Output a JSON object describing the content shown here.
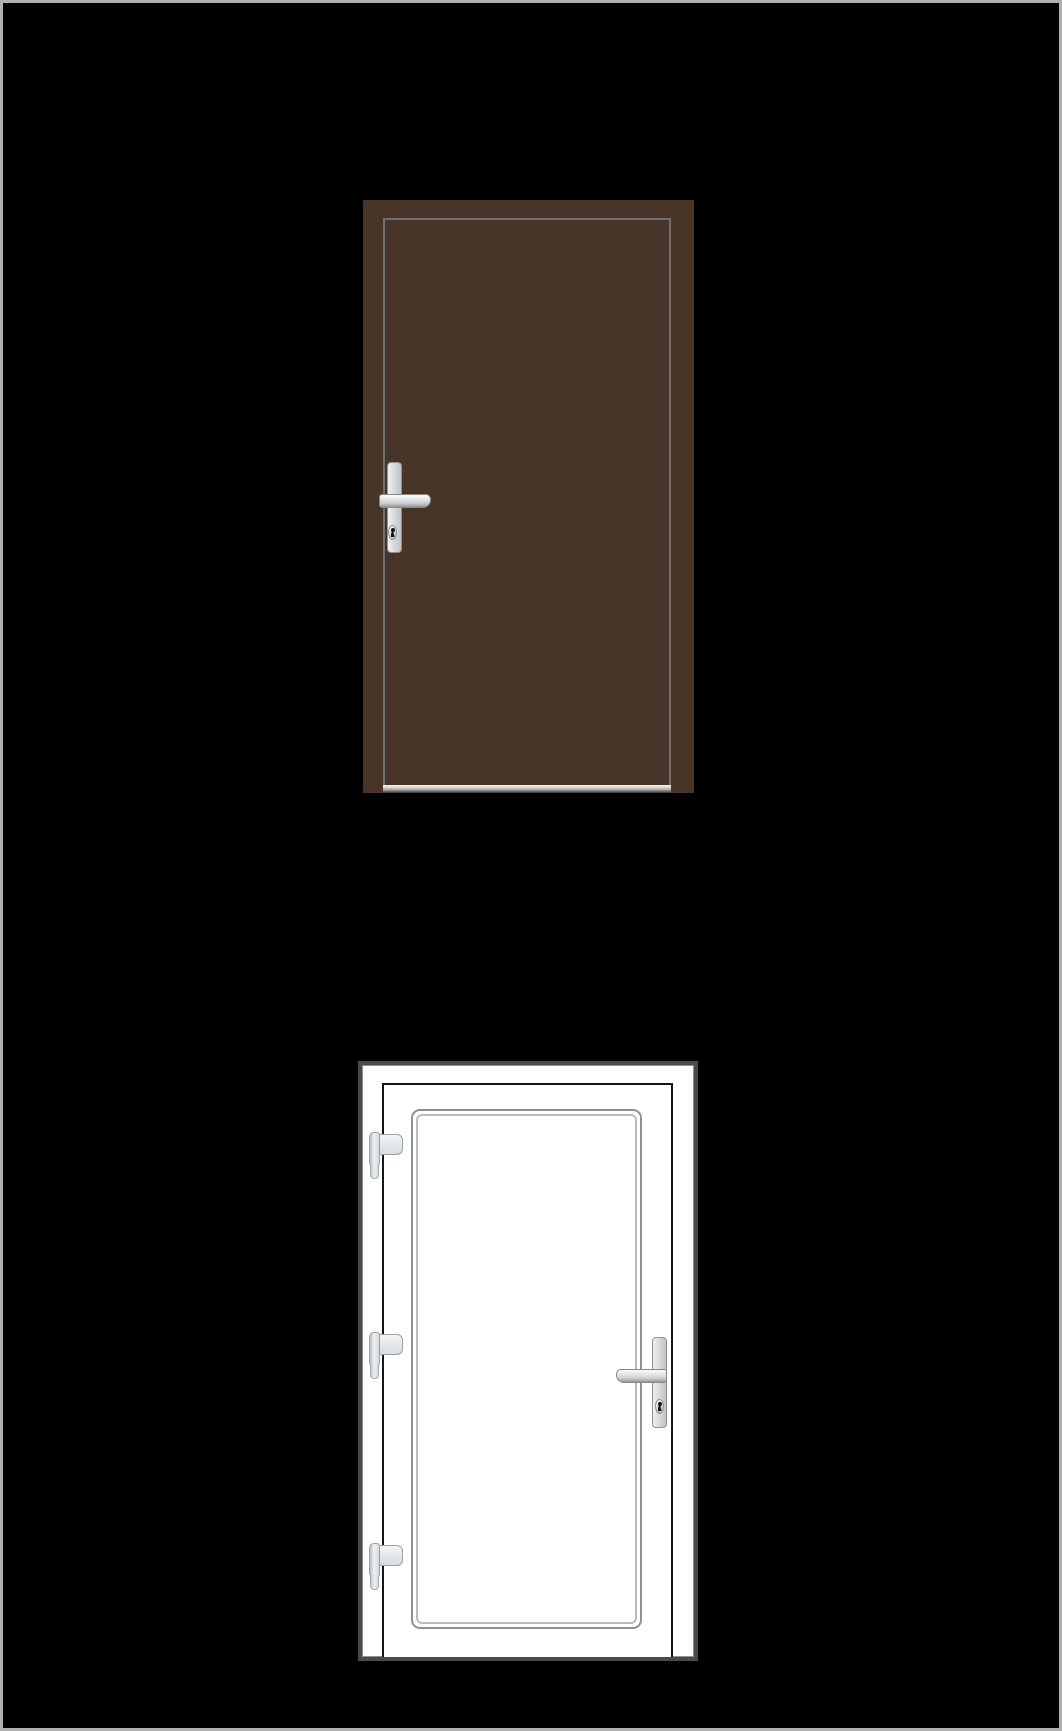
{
  "canvas": {
    "width_px": 1062,
    "height_px": 1731,
    "background": "#000000",
    "frame_border_color": "#b0b0b0",
    "description": "Two exterior-door product renderings stacked vertically on a black background"
  },
  "doors": [
    {
      "label": "brown solid slab door",
      "finish": "dark brown",
      "slab_color": "#473528",
      "leaf_outline_color": "#6f6f6f",
      "threshold_colors": [
        "#f2f2f2",
        "#ababab",
        "#3a3a3a"
      ],
      "hardware_finish": "silver",
      "handle_side": "left",
      "handle_parts": [
        "backplate",
        "lever",
        "keyhole"
      ],
      "visible_hinge_count": 0
    },
    {
      "label": "white glazed panel door with frame",
      "finish": "white",
      "frame_color": "#ffffff",
      "frame_edge_color": "#4a4a4c",
      "leaf_outline_color": "#161616",
      "glazing_bead_outer_color": "#8d9296",
      "glazing_bead_inner_color": "#b8bcbf",
      "hardware_finish": "silver",
      "handle_side": "right",
      "handle_parts": [
        "backplate",
        "lever",
        "keyhole"
      ],
      "visible_hinge_count": 3,
      "hinge_side": "left",
      "hinge_positions": [
        "top",
        "middle",
        "bottom"
      ]
    }
  ]
}
